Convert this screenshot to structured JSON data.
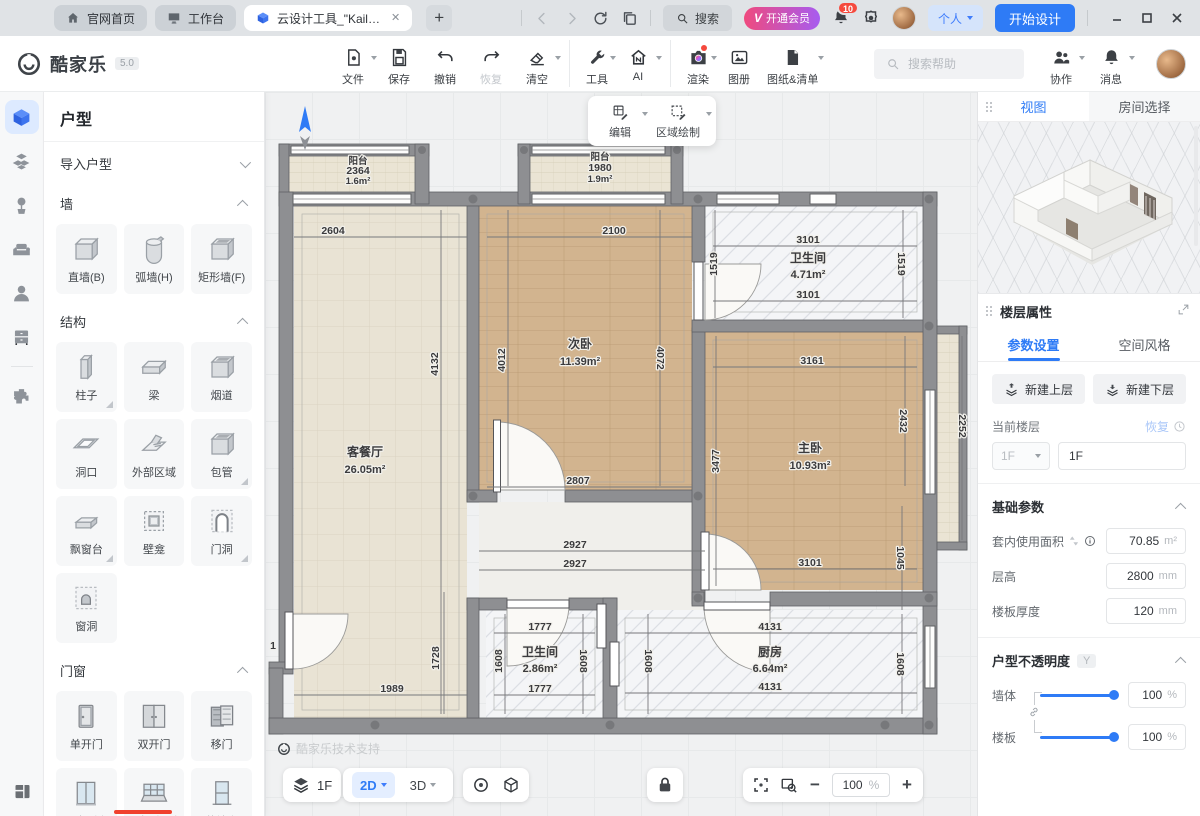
{
  "colors": {
    "accent": "#2e7bf6",
    "vip_from": "#ef4a7e",
    "vip_to": "#a75cf0",
    "badge_red": "#f5493d",
    "wall_gray": "#8e8f92",
    "wood": "#d2b48f",
    "tile_beige": "#e9e3d4",
    "marble": "#f4f5f7"
  },
  "titlebar": {
    "tabs": [
      {
        "label": "官网首页",
        "icon": "#i-home"
      },
      {
        "label": "工作台",
        "icon": "#i-monitor"
      },
      {
        "label": "云设计工具_\"Kail…",
        "icon": "#i-appcube",
        "active": true
      }
    ],
    "search_label": "搜索",
    "vip_label": "开通会员",
    "vip_v": "V",
    "notification_count": "10",
    "user_menu_label": "个人",
    "start_design_label": "开始设计"
  },
  "toolbar": {
    "brand": "酷家乐",
    "version": "5.0",
    "items": [
      {
        "label": "文件",
        "icon": "#i-file",
        "caret": true
      },
      {
        "label": "保存",
        "icon": "#i-save"
      },
      {
        "label": "撤销",
        "icon": "#i-undo"
      },
      {
        "label": "恢复",
        "icon": "#i-redo",
        "disabled": true
      },
      {
        "label": "清空",
        "icon": "#i-eraser",
        "caret": true
      },
      {
        "label": "工具",
        "icon": "#i-wrench",
        "caret": true,
        "sep": true
      },
      {
        "label": "AI",
        "icon": "#i-ai",
        "caret": true
      },
      {
        "label": "渲染",
        "icon": "#i-camera",
        "caret": true,
        "dot": true,
        "sep": true
      },
      {
        "label": "图册",
        "icon": "#i-album"
      },
      {
        "label": "图纸&清单",
        "icon": "#i-sheet",
        "caret": true
      }
    ],
    "help_placeholder": "搜索帮助",
    "right_items": [
      {
        "label": "协作",
        "icon": "#i-people",
        "caret": true
      },
      {
        "label": "消息",
        "icon": "#i-bell2",
        "caret": true
      }
    ]
  },
  "left_panel": {
    "title": "户型",
    "sections": {
      "import": {
        "label": "导入户型"
      },
      "wall": {
        "label": "墙",
        "items": [
          {
            "label": "直墙(B)",
            "icon": "#s-box"
          },
          {
            "label": "弧墙(H)",
            "icon": "#s-arc"
          },
          {
            "label": "矩形墙(F)",
            "icon": "#s-cube1"
          }
        ]
      },
      "structure": {
        "label": "结构",
        "items": [
          {
            "label": "柱子",
            "icon": "#s-column",
            "corner": true
          },
          {
            "label": "梁",
            "icon": "#s-beam"
          },
          {
            "label": "烟道",
            "icon": "#s-cube1"
          },
          {
            "label": "洞口",
            "icon": "#s-hole"
          },
          {
            "label": "外部区域",
            "icon": "#s-ext"
          },
          {
            "label": "包管",
            "icon": "#s-cube1",
            "corner": true
          },
          {
            "label": "飘窗台",
            "icon": "#s-bay",
            "corner": true
          },
          {
            "label": "壁龛",
            "icon": "#s-niche"
          },
          {
            "label": "门洞",
            "icon": "#s-doorway",
            "corner": true
          },
          {
            "label": "窗洞",
            "icon": "#s-winhole"
          }
        ]
      },
      "doorwin": {
        "label": "门窗",
        "items": [
          {
            "label": "单开门",
            "icon": "#s-door1"
          },
          {
            "label": "双开门",
            "icon": "#s-door2"
          },
          {
            "label": "移门",
            "icon": "#s-slide"
          },
          {
            "label": "一字型窗",
            "icon": "#s-win"
          },
          {
            "label": "一字型飘窗",
            "icon": "#s-baywin"
          },
          {
            "label": "落地窗",
            "icon": "#s-floorwin"
          }
        ]
      }
    }
  },
  "canvas": {
    "edit_toolbar": [
      {
        "label": "编辑",
        "icon": "#i-edit"
      },
      {
        "label": "区域绘制",
        "icon": "#i-region"
      }
    ],
    "watermark": "酷家乐技术支持",
    "labels": [
      {
        "t": "阳台",
        "x": 93,
        "y": 72,
        "k": "rs"
      },
      {
        "t": "2364",
        "x": 93,
        "y": 82
      },
      {
        "t": "1.6m²",
        "x": 93,
        "y": 92,
        "k": "as"
      },
      {
        "t": "阳台",
        "x": 335,
        "y": 68,
        "k": "rs"
      },
      {
        "t": "1980",
        "x": 335,
        "y": 79
      },
      {
        "t": "1.9m²",
        "x": 335,
        "y": 90,
        "k": "as"
      },
      {
        "t": "2604",
        "x": 68,
        "y": 142
      },
      {
        "t": "2100",
        "x": 349,
        "y": 142
      },
      {
        "t": "3101",
        "x": 543,
        "y": 151
      },
      {
        "t": "卫生间",
        "x": 543,
        "y": 170,
        "k": "room"
      },
      {
        "t": "4.71m²",
        "x": 543,
        "y": 186,
        "k": "area"
      },
      {
        "t": "3101",
        "x": 543,
        "y": 206
      },
      {
        "t": "1519",
        "x": 452,
        "y": 172,
        "r": -90
      },
      {
        "t": "1519",
        "x": 633,
        "y": 172,
        "r": 90
      },
      {
        "t": "3161",
        "x": 547,
        "y": 272
      },
      {
        "t": "4132",
        "x": 173,
        "y": 272,
        "r": -90
      },
      {
        "t": "4012",
        "x": 240,
        "y": 268,
        "r": -90
      },
      {
        "t": "次卧",
        "x": 315,
        "y": 256,
        "k": "room"
      },
      {
        "t": "11.39m²",
        "x": 315,
        "y": 273,
        "k": "area"
      },
      {
        "t": "4072",
        "x": 392,
        "y": 266,
        "r": 90
      },
      {
        "t": "2432",
        "x": 635,
        "y": 329,
        "r": 90
      },
      {
        "t": "2252",
        "x": 694,
        "y": 334,
        "r": 90
      },
      {
        "t": "3477",
        "x": 454,
        "y": 369,
        "r": -90
      },
      {
        "t": "主卧",
        "x": 545,
        "y": 360,
        "k": "room"
      },
      {
        "t": "10.93m²",
        "x": 545,
        "y": 377,
        "k": "area"
      },
      {
        "t": "客餐厅",
        "x": 100,
        "y": 364,
        "k": "room"
      },
      {
        "t": "26.05m²",
        "x": 100,
        "y": 381,
        "k": "area"
      },
      {
        "t": "2807",
        "x": 313,
        "y": 392
      },
      {
        "t": "2927",
        "x": 310,
        "y": 456
      },
      {
        "t": "2927",
        "x": 310,
        "y": 475
      },
      {
        "t": "3101",
        "x": 545,
        "y": 474
      },
      {
        "t": "1045",
        "x": 632,
        "y": 466,
        "r": 90
      },
      {
        "t": "1777",
        "x": 275,
        "y": 538
      },
      {
        "t": "1728",
        "x": 174,
        "y": 566,
        "r": -90
      },
      {
        "t": "1608",
        "x": 237,
        "y": 569,
        "r": -90
      },
      {
        "t": "卫生间",
        "x": 275,
        "y": 564,
        "k": "room"
      },
      {
        "t": "2.86m²",
        "x": 275,
        "y": 580,
        "k": "area"
      },
      {
        "t": "1608",
        "x": 315,
        "y": 569,
        "r": 90
      },
      {
        "t": "1608",
        "x": 380,
        "y": 569,
        "r": 90
      },
      {
        "t": "4131",
        "x": 505,
        "y": 538
      },
      {
        "t": "厨房",
        "x": 505,
        "y": 564,
        "k": "room"
      },
      {
        "t": "6.64m²",
        "x": 505,
        "y": 580,
        "k": "area"
      },
      {
        "t": "1608",
        "x": 632,
        "y": 572,
        "r": 90
      },
      {
        "t": "1777",
        "x": 275,
        "y": 600
      },
      {
        "t": "4131",
        "x": 505,
        "y": 598
      },
      {
        "t": "1989",
        "x": 127,
        "y": 600
      },
      {
        "t": "1",
        "x": 8,
        "y": 557
      }
    ]
  },
  "bottom_bar": {
    "floor": "1F",
    "mode_2d": "2D",
    "mode_3d": "3D",
    "zoom": "100",
    "zoom_unit": "%"
  },
  "right_panel": {
    "tabs": {
      "view": "视图",
      "room_select": "房间选择"
    },
    "floor_props_title": "楼层属性",
    "sub_tabs": {
      "params": "参数设置",
      "style": "空间风格"
    },
    "new_upper": "新建上层",
    "new_lower": "新建下层",
    "current_floor_label": "当前楼层",
    "restore_label": "恢复",
    "floor_select": "1F",
    "floor_name": "1F",
    "basic_params_title": "基础参数",
    "fields": [
      {
        "label": "套内使用面积",
        "value": "70.85",
        "unit": "m²",
        "icons": true
      },
      {
        "label": "层高",
        "value": "2800",
        "unit": "mm"
      },
      {
        "label": "楼板厚度",
        "value": "120",
        "unit": "mm"
      }
    ],
    "opacity_title": "户型不透明度",
    "opacity_key": "Y",
    "sliders": [
      {
        "label": "墙体",
        "value": "100",
        "unit": "%"
      },
      {
        "label": "楼板",
        "value": "100",
        "unit": "%"
      }
    ]
  }
}
